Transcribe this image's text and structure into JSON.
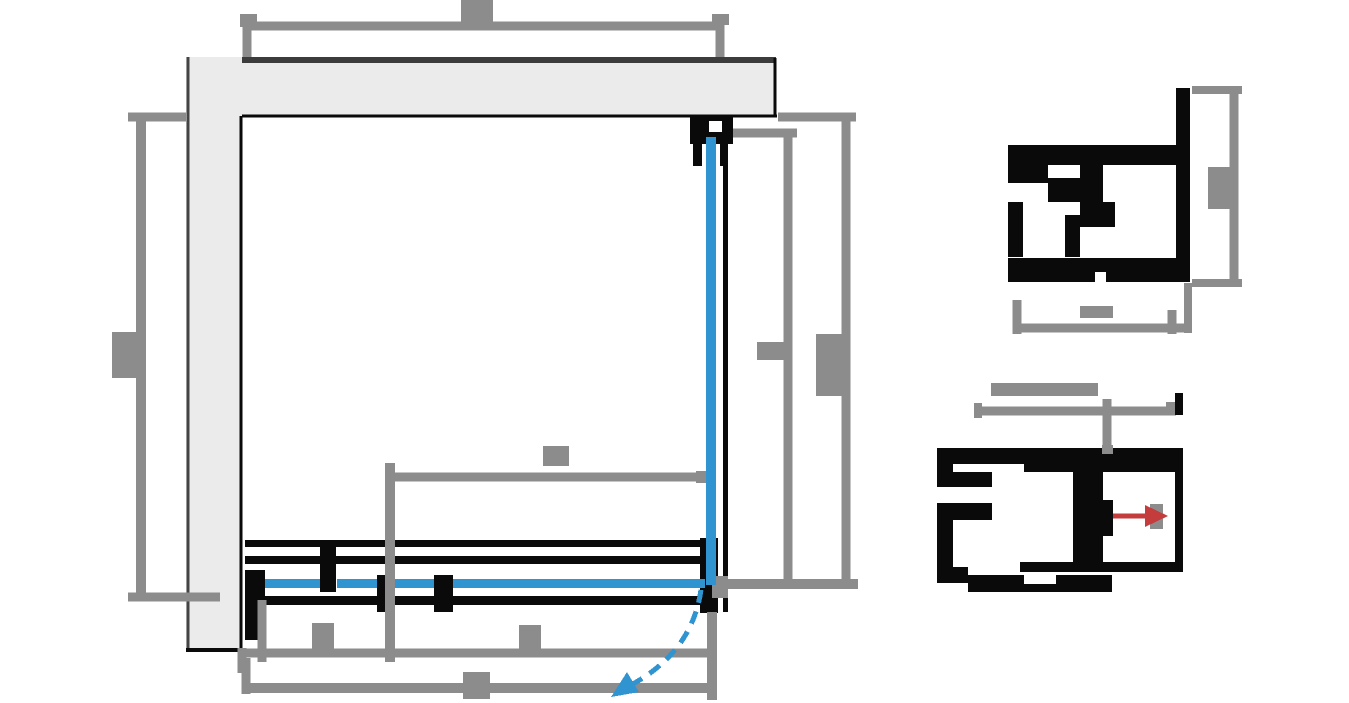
{
  "meta": {
    "type": "technical-drawing",
    "description": "Plan-view CAD drawing of a corner shower enclosure: top and left walls, sliding door track assembly with glass panels, fixed side glass panel, dashed door-swing arc, two enlarged aluminium profile cross-section details, and pixelated (illegible) dimension labels on gray dimension lines.",
    "canvas": {
      "width": 1349,
      "height": 703
    },
    "labels_note": "All dimension labels in the source image are rasterized pixel blobs with no legible characters; they are reproduced as gray blob rectangles."
  },
  "colors": {
    "background": "#ffffff",
    "wall_fill": "#ebebeb",
    "wall_top_strip": "#3c3c3c",
    "wall_edge_dark": "#444444",
    "profile_black": "#0a0a0a",
    "dimension_gray": "#8c8c8c",
    "glass_blue": "#3094d1",
    "arrow_red": "#c43c3c"
  },
  "svg": {
    "viewbox": "0 0 1349 703",
    "shapes": [
      {
        "t": "rect",
        "n": "wall-top",
        "x": 186,
        "y": 57,
        "w": 590,
        "h": 59,
        "f": "#ebebeb"
      },
      {
        "t": "rect",
        "n": "wall-top-edge-strip",
        "x": 186,
        "y": 57,
        "w": 590,
        "h": 6,
        "f": "#3c3c3c"
      },
      {
        "t": "line",
        "n": "wall-top-bottom-line",
        "x1": 240,
        "y1": 116,
        "x2": 777,
        "y2": 116,
        "s": "#0a0a0a",
        "sw": 3
      },
      {
        "t": "line",
        "n": "wall-top-right-line",
        "x1": 775,
        "y1": 58,
        "x2": 775,
        "y2": 116,
        "s": "#0a0a0a",
        "sw": 3
      },
      {
        "t": "rect",
        "n": "wall-left",
        "x": 186,
        "y": 57,
        "w": 56,
        "h": 593,
        "f": "#ebebeb"
      },
      {
        "t": "line",
        "n": "wall-left-left-line",
        "x1": 188,
        "y1": 57,
        "x2": 188,
        "y2": 650,
        "s": "#444444",
        "sw": 3
      },
      {
        "t": "line",
        "n": "wall-left-right-line",
        "x1": 241,
        "y1": 116,
        "x2": 241,
        "y2": 650,
        "s": "#0a0a0a",
        "sw": 3
      },
      {
        "t": "line",
        "n": "wall-left-bottom-line",
        "x1": 186,
        "y1": 650,
        "x2": 243,
        "y2": 650,
        "s": "#0a0a0a",
        "sw": 4
      },
      {
        "t": "rect",
        "n": "corner-wall-bracket",
        "x": 690,
        "y": 117,
        "w": 43,
        "h": 27,
        "f": "#0a0a0a"
      },
      {
        "t": "rect",
        "n": "corner-bracket-notch",
        "x": 709,
        "y": 121,
        "w": 13,
        "h": 11,
        "f": "#ffffff"
      },
      {
        "t": "rect",
        "n": "side-panel-profile",
        "x": 723,
        "y": 117,
        "w": 5,
        "h": 495,
        "f": "#0a0a0a"
      },
      {
        "t": "rect",
        "n": "glass-clamp-left",
        "x": 693,
        "y": 144,
        "w": 9,
        "h": 22,
        "f": "#0a0a0a"
      },
      {
        "t": "rect",
        "n": "glass-clamp-right",
        "x": 720,
        "y": 144,
        "w": 8,
        "h": 22,
        "f": "#0a0a0a"
      },
      {
        "t": "rect",
        "n": "door-rail-top-outer",
        "x": 245,
        "y": 540,
        "w": 473,
        "h": 7,
        "f": "#0a0a0a"
      },
      {
        "t": "rect",
        "n": "door-rail-top-inner",
        "x": 245,
        "y": 556,
        "w": 473,
        "h": 8,
        "f": "#0a0a0a"
      },
      {
        "t": "rect",
        "n": "door-rail-bottom",
        "x": 245,
        "y": 596,
        "w": 473,
        "h": 9,
        "f": "#0a0a0a"
      },
      {
        "t": "rect",
        "n": "door-stop-left",
        "x": 245,
        "y": 570,
        "w": 20,
        "h": 70,
        "f": "#0a0a0a"
      },
      {
        "t": "rect",
        "n": "door-roller-1",
        "x": 320,
        "y": 540,
        "w": 16,
        "h": 52,
        "f": "#0a0a0a"
      },
      {
        "t": "rect",
        "n": "door-roller-2",
        "x": 377,
        "y": 575,
        "w": 16,
        "h": 37,
        "f": "#0a0a0a"
      },
      {
        "t": "rect",
        "n": "door-roller-3",
        "x": 434,
        "y": 575,
        "w": 19,
        "h": 37,
        "f": "#0a0a0a"
      },
      {
        "t": "rect",
        "n": "corner-block",
        "x": 700,
        "y": 538,
        "w": 18,
        "h": 75,
        "f": "#0a0a0a"
      },
      {
        "t": "line",
        "n": "dim-top-line",
        "x1": 247,
        "y1": 26,
        "x2": 722,
        "y2": 26,
        "s": "#8c8c8c",
        "sw": 9
      },
      {
        "t": "line",
        "n": "dim-top-ext-left",
        "x1": 247,
        "y1": 14,
        "x2": 247,
        "y2": 57,
        "s": "#8c8c8c",
        "sw": 9
      },
      {
        "t": "rect",
        "n": "dim-top-tick-left",
        "x": 240,
        "y": 14,
        "w": 17,
        "h": 13,
        "f": "#8c8c8c"
      },
      {
        "t": "line",
        "n": "dim-top-ext-right",
        "x1": 720,
        "y1": 14,
        "x2": 720,
        "y2": 57,
        "s": "#8c8c8c",
        "sw": 9
      },
      {
        "t": "rect",
        "n": "dim-top-tick-right",
        "x": 712,
        "y": 14,
        "w": 17,
        "h": 11,
        "f": "#8c8c8c"
      },
      {
        "t": "rect",
        "n": "dim-label-top-blob",
        "x": 461,
        "y": 0,
        "w": 32,
        "h": 26,
        "f": "#8c8c8c"
      },
      {
        "t": "line",
        "n": "dim-left-line",
        "x1": 141,
        "y1": 117,
        "x2": 141,
        "y2": 597,
        "s": "#8c8c8c",
        "sw": 10
      },
      {
        "t": "line",
        "n": "dim-left-ext-top",
        "x1": 128,
        "y1": 117,
        "x2": 186,
        "y2": 117,
        "s": "#8c8c8c",
        "sw": 9
      },
      {
        "t": "line",
        "n": "dim-left-ext-bottom",
        "x1": 128,
        "y1": 597,
        "x2": 220,
        "y2": 597,
        "s": "#8c8c8c",
        "sw": 9
      },
      {
        "t": "rect",
        "n": "dim-label-left-blob",
        "x": 112,
        "y": 332,
        "w": 31,
        "h": 46,
        "f": "#8c8c8c"
      },
      {
        "t": "line",
        "n": "dim-right-inner-line",
        "x1": 788,
        "y1": 133,
        "x2": 788,
        "y2": 584,
        "s": "#8c8c8c",
        "sw": 9
      },
      {
        "t": "line",
        "n": "dim-right-inner-ext-top",
        "x1": 733,
        "y1": 133,
        "x2": 797,
        "y2": 133,
        "s": "#8c8c8c",
        "sw": 9
      },
      {
        "t": "line",
        "n": "dim-right-outer-line",
        "x1": 846,
        "y1": 117,
        "x2": 846,
        "y2": 584,
        "s": "#8c8c8c",
        "sw": 9
      },
      {
        "t": "line",
        "n": "dim-right-outer-ext-top",
        "x1": 778,
        "y1": 117,
        "x2": 856,
        "y2": 117,
        "s": "#8c8c8c",
        "sw": 9
      },
      {
        "t": "line",
        "n": "dim-right-ext-bottom",
        "x1": 714,
        "y1": 584,
        "x2": 858,
        "y2": 584,
        "s": "#8c8c8c",
        "sw": 10
      },
      {
        "t": "rect",
        "n": "dim-label-right-inner-blob",
        "x": 757,
        "y": 342,
        "w": 31,
        "h": 18,
        "f": "#8c8c8c"
      },
      {
        "t": "rect",
        "n": "dim-label-right-outer-blob",
        "x": 816,
        "y": 334,
        "w": 31,
        "h": 62,
        "f": "#8c8c8c"
      },
      {
        "t": "line",
        "n": "dim-mid-line",
        "x1": 392,
        "y1": 477,
        "x2": 706,
        "y2": 477,
        "s": "#8c8c8c",
        "sw": 9
      },
      {
        "t": "line",
        "n": "dim-mid-ext-left",
        "x1": 390,
        "y1": 463,
        "x2": 390,
        "y2": 662,
        "s": "#8c8c8c",
        "sw": 10
      },
      {
        "t": "rect",
        "n": "dim-mid-arrow",
        "x": 696,
        "y": 471,
        "w": 13,
        "h": 12,
        "f": "#8c8c8c"
      },
      {
        "t": "rect",
        "n": "dim-label-mid-blob",
        "x": 543,
        "y": 446,
        "w": 26,
        "h": 20,
        "f": "#8c8c8c"
      },
      {
        "t": "line",
        "n": "dim-bottom1-line",
        "x1": 242,
        "y1": 653,
        "x2": 712,
        "y2": 653,
        "s": "#8c8c8c",
        "sw": 9
      },
      {
        "t": "line",
        "n": "dim-bottom1-ext-left",
        "x1": 242,
        "y1": 648,
        "x2": 242,
        "y2": 673,
        "s": "#8c8c8c",
        "sw": 9
      },
      {
        "t": "line",
        "n": "dim-bottom1-tick-left",
        "x1": 262,
        "y1": 600,
        "x2": 262,
        "y2": 662,
        "s": "#8c8c8c",
        "sw": 9
      },
      {
        "t": "rect",
        "n": "dim-label-bottom1a-blob",
        "x": 312,
        "y": 623,
        "w": 22,
        "h": 28,
        "f": "#8c8c8c"
      },
      {
        "t": "rect",
        "n": "dim-label-bottom1b-blob",
        "x": 519,
        "y": 625,
        "w": 22,
        "h": 26,
        "f": "#8c8c8c"
      },
      {
        "t": "line",
        "n": "dim-bottom2-line",
        "x1": 245,
        "y1": 688,
        "x2": 712,
        "y2": 688,
        "s": "#8c8c8c",
        "sw": 10
      },
      {
        "t": "line",
        "n": "dim-bottom2-ext-left",
        "x1": 246,
        "y1": 658,
        "x2": 246,
        "y2": 694,
        "s": "#8c8c8c",
        "sw": 9
      },
      {
        "t": "line",
        "n": "dim-right-shared-ext",
        "x1": 712,
        "y1": 612,
        "x2": 712,
        "y2": 700,
        "s": "#8c8c8c",
        "sw": 10
      },
      {
        "t": "rect",
        "n": "dim-label-bottom2-blob",
        "x": 463,
        "y": 672,
        "w": 27,
        "h": 27,
        "f": "#8c8c8c"
      },
      {
        "t": "rect",
        "n": "dim-corner-junction",
        "x": 712,
        "y": 576,
        "w": 16,
        "h": 22,
        "f": "#8c8c8c"
      },
      {
        "t": "rect",
        "n": "glass-side-panel",
        "x": 706,
        "y": 137,
        "w": 10,
        "h": 448,
        "f": "#3094d1"
      },
      {
        "t": "rect",
        "n": "glass-door-seg1",
        "x": 265,
        "y": 579,
        "w": 55,
        "h": 9,
        "f": "#3094d1"
      },
      {
        "t": "rect",
        "n": "glass-door-seg2",
        "x": 337,
        "y": 579,
        "w": 40,
        "h": 9,
        "f": "#3094d1"
      },
      {
        "t": "rect",
        "n": "glass-door-seg3",
        "x": 395,
        "y": 579,
        "w": 39,
        "h": 9,
        "f": "#3094d1"
      },
      {
        "t": "rect",
        "n": "glass-door-seg4",
        "x": 453,
        "y": 579,
        "w": 252,
        "h": 9,
        "f": "#3094d1"
      },
      {
        "t": "path",
        "n": "door-swing-arc",
        "d": "M701,590 Q692,652 631,685",
        "s": "#3094d1",
        "sw": 5,
        "dash": "13 9",
        "f": "none"
      },
      {
        "t": "poly",
        "n": "door-swing-arrowhead",
        "p": "611,697 639,692 627,672",
        "f": "#3094d1"
      },
      {
        "t": "rect",
        "n": "d1-right-bar",
        "x": 1176,
        "y": 88,
        "w": 14,
        "h": 192,
        "f": "#0a0a0a"
      },
      {
        "t": "rect",
        "n": "d1-top-arm",
        "x": 1008,
        "y": 145,
        "w": 170,
        "h": 20,
        "f": "#0a0a0a"
      },
      {
        "t": "rect",
        "n": "d1-arm-hook",
        "x": 1008,
        "y": 165,
        "w": 40,
        "h": 18,
        "f": "#0a0a0a"
      },
      {
        "t": "rect",
        "n": "d1-hook-step",
        "x": 1048,
        "y": 178,
        "w": 32,
        "h": 24,
        "f": "#0a0a0a"
      },
      {
        "t": "rect",
        "n": "d1-mid-stub",
        "x": 1080,
        "y": 165,
        "w": 23,
        "h": 62,
        "f": "#0a0a0a"
      },
      {
        "t": "rect",
        "n": "d1-mid-stub-bump",
        "x": 1103,
        "y": 202,
        "w": 12,
        "h": 25,
        "f": "#0a0a0a"
      },
      {
        "t": "rect",
        "n": "d1-left-edge",
        "x": 1008,
        "y": 202,
        "w": 15,
        "h": 55,
        "f": "#0a0a0a"
      },
      {
        "t": "rect",
        "n": "d1-window-right-wall",
        "x": 1065,
        "y": 215,
        "w": 15,
        "h": 42,
        "f": "#0a0a0a"
      },
      {
        "t": "rect",
        "n": "d1-bottom-bar",
        "x": 1008,
        "y": 258,
        "w": 182,
        "h": 24,
        "f": "#0a0a0a"
      },
      {
        "t": "rect",
        "n": "d1-bottom-gap",
        "x": 1095,
        "y": 272,
        "w": 11,
        "h": 10,
        "f": "#ffffff"
      },
      {
        "t": "line",
        "n": "d1-dim-right-line",
        "x1": 1234,
        "y1": 90,
        "x2": 1234,
        "y2": 283,
        "s": "#8c8c8c",
        "sw": 9
      },
      {
        "t": "line",
        "n": "d1-dim-right-ext-top",
        "x1": 1192,
        "y1": 90,
        "x2": 1242,
        "y2": 90,
        "s": "#8c8c8c",
        "sw": 8
      },
      {
        "t": "line",
        "n": "d1-dim-right-ext-bottom",
        "x1": 1192,
        "y1": 283,
        "x2": 1242,
        "y2": 283,
        "s": "#8c8c8c",
        "sw": 8
      },
      {
        "t": "rect",
        "n": "d1-label-right-blob",
        "x": 1208,
        "y": 167,
        "w": 22,
        "h": 42,
        "f": "#8c8c8c"
      },
      {
        "t": "line",
        "n": "d1-dim-bottom-line",
        "x1": 1015,
        "y1": 328,
        "x2": 1190,
        "y2": 328,
        "s": "#8c8c8c",
        "sw": 9
      },
      {
        "t": "line",
        "n": "d1-dim-bottom-tick-left",
        "x1": 1017,
        "y1": 300,
        "x2": 1017,
        "y2": 334,
        "s": "#8c8c8c",
        "sw": 9
      },
      {
        "t": "line",
        "n": "d1-dim-bottom-tick-right",
        "x1": 1172,
        "y1": 310,
        "x2": 1172,
        "y2": 334,
        "s": "#8c8c8c",
        "sw": 9
      },
      {
        "t": "line",
        "n": "d1-profile-ext-right",
        "x1": 1188,
        "y1": 283,
        "x2": 1188,
        "y2": 333,
        "s": "#8c8c8c",
        "sw": 8
      },
      {
        "t": "rect",
        "n": "d1-label-bottom-blob",
        "x": 1080,
        "y": 306,
        "w": 33,
        "h": 12,
        "f": "#8c8c8c"
      },
      {
        "t": "rect",
        "n": "d2-top-bar",
        "x": 937,
        "y": 448,
        "w": 246,
        "h": 16,
        "f": "#0a0a0a"
      },
      {
        "t": "rect",
        "n": "d2-top-bar-right-thick",
        "x": 1024,
        "y": 448,
        "w": 153,
        "h": 24,
        "f": "#0a0a0a"
      },
      {
        "t": "rect",
        "n": "d2-left-edge-upper",
        "x": 937,
        "y": 448,
        "w": 16,
        "h": 39,
        "f": "#0a0a0a"
      },
      {
        "t": "rect",
        "n": "d2-left-edge-lower",
        "x": 937,
        "y": 503,
        "w": 16,
        "h": 80,
        "f": "#0a0a0a"
      },
      {
        "t": "rect",
        "n": "d2-inner-block-1",
        "x": 953,
        "y": 472,
        "w": 39,
        "h": 15,
        "f": "#0a0a0a"
      },
      {
        "t": "rect",
        "n": "d2-inner-block-2",
        "x": 953,
        "y": 503,
        "w": 39,
        "h": 17,
        "f": "#0a0a0a"
      },
      {
        "t": "rect",
        "n": "d2-left-foot",
        "x": 953,
        "y": 567,
        "w": 15,
        "h": 16,
        "f": "#0a0a0a"
      },
      {
        "t": "rect",
        "n": "d2-bottom-bar-upper",
        "x": 1020,
        "y": 562,
        "w": 163,
        "h": 10,
        "f": "#0a0a0a"
      },
      {
        "t": "rect",
        "n": "d2-bottom-bar-lower",
        "x": 968,
        "y": 575,
        "w": 144,
        "h": 17,
        "f": "#0a0a0a"
      },
      {
        "t": "rect",
        "n": "d2-bottom-gap",
        "x": 1024,
        "y": 575,
        "w": 32,
        "h": 9,
        "f": "#ffffff"
      },
      {
        "t": "rect",
        "n": "d2-right-edge",
        "x": 1175,
        "y": 448,
        "w": 8,
        "h": 124,
        "f": "#0a0a0a"
      },
      {
        "t": "rect",
        "n": "d2-divider",
        "x": 1073,
        "y": 472,
        "w": 30,
        "h": 90,
        "f": "#0a0a0a"
      },
      {
        "t": "rect",
        "n": "d2-divider-bump",
        "x": 1097,
        "y": 500,
        "w": 16,
        "h": 36,
        "f": "#0a0a0a"
      },
      {
        "t": "rect",
        "n": "d2-label-long-blob",
        "x": 991,
        "y": 383,
        "w": 107,
        "h": 13,
        "f": "#8c8c8c"
      },
      {
        "t": "line",
        "n": "d2-dim-line",
        "x1": 978,
        "y1": 411,
        "x2": 1176,
        "y2": 411,
        "s": "#8c8c8c",
        "sw": 9
      },
      {
        "t": "line",
        "n": "d2-dim-tick-left",
        "x1": 978,
        "y1": 403,
        "x2": 978,
        "y2": 418,
        "s": "#8c8c8c",
        "sw": 8
      },
      {
        "t": "line",
        "n": "d2-dim-tick-mid",
        "x1": 1107,
        "y1": 399,
        "x2": 1107,
        "y2": 447,
        "s": "#8c8c8c",
        "sw": 9
      },
      {
        "t": "rect",
        "n": "d2-tick-mid-foot",
        "x": 1102,
        "y": 445,
        "w": 11,
        "h": 9,
        "f": "#8c8c8c"
      },
      {
        "t": "rect",
        "n": "d2-tick-right-gray",
        "x": 1166,
        "y": 402,
        "w": 10,
        "h": 11,
        "f": "#8c8c8c"
      },
      {
        "t": "rect",
        "n": "d2-tick-right-black",
        "x": 1175,
        "y": 393,
        "w": 8,
        "h": 22,
        "f": "#0a0a0a"
      },
      {
        "t": "rect",
        "n": "d2-arrow-base-gray",
        "x": 1150,
        "y": 504,
        "w": 13,
        "h": 25,
        "f": "#8c8c8c"
      },
      {
        "t": "line",
        "n": "d2-adjust-arrow-shaft",
        "x1": 1113,
        "y1": 516,
        "x2": 1152,
        "y2": 516,
        "s": "#c43c3c",
        "sw": 5
      },
      {
        "t": "poly",
        "n": "d2-adjust-arrowhead",
        "p": "1168,516 1145,505 1145,527",
        "f": "#c43c3c"
      }
    ]
  }
}
